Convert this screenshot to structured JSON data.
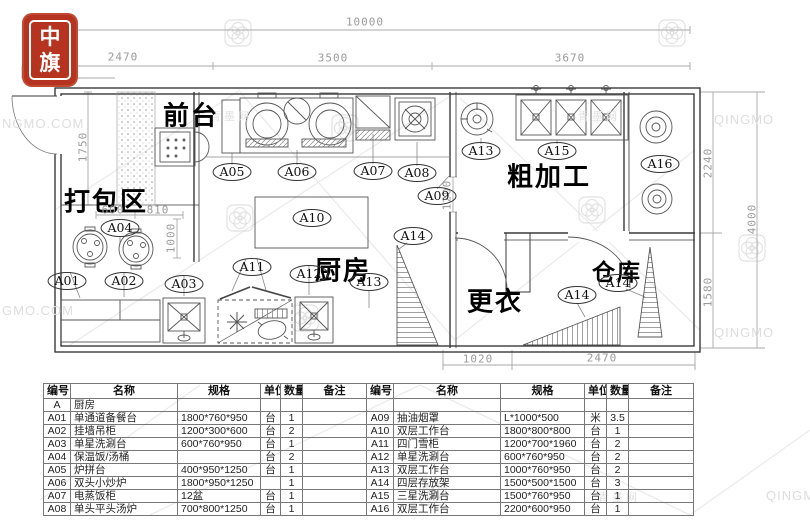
{
  "logo": {
    "char1": "中",
    "char2": "旗",
    "color": "#b5331f"
  },
  "watermarks": {
    "site_partial_left1": "NGMO.COM",
    "site_partial_left2": "GMO.COM",
    "site_short": "QINGMO",
    "cjk": "青墨网"
  },
  "plan": {
    "rooms": {
      "front_desk": "前台",
      "packing_area": "打包区",
      "kitchen": "厨房",
      "rough_processing": "粗加工",
      "changing": "更衣",
      "storage": "仓库"
    },
    "dims": {
      "overall_width": "10000",
      "seg_left": "2470",
      "seg_mid": "3500",
      "seg_right": "3670",
      "front_depth": "1750",
      "right_upper": "2240",
      "right_lower": "1580",
      "overall_height": "4000",
      "pack_a": "600",
      "pack_b": "810",
      "pack_c": "1000",
      "hood_gap": "1200",
      "bottom_left": "1020",
      "bottom_right": "2470"
    },
    "tags": [
      "A05",
      "A06",
      "A07",
      "A08",
      "A13",
      "A15",
      "A16",
      "A09",
      "A10",
      "A04",
      "A01",
      "A02",
      "A03",
      "A11",
      "A12",
      "A13",
      "A14",
      "A14",
      "A14"
    ]
  },
  "table": {
    "headers": {
      "id": "编号",
      "name": "名称",
      "spec": "规格",
      "unit": "单位",
      "qty": "数量",
      "note": "备注"
    },
    "category": {
      "id": "A",
      "name": "厨房"
    },
    "left_rows": [
      {
        "id": "A01",
        "name": "单通道备餐台",
        "spec": "1800*760*950",
        "unit": "台",
        "qty": "1",
        "note": ""
      },
      {
        "id": "A02",
        "name": "挂墙吊柜",
        "spec": "1200*300*600",
        "unit": "台",
        "qty": "2",
        "note": ""
      },
      {
        "id": "A03",
        "name": "单星洗涮台",
        "spec": "600*760*950",
        "unit": "台",
        "qty": "1",
        "note": ""
      },
      {
        "id": "A04",
        "name": "保温饭/汤桶",
        "spec": "",
        "unit": "台",
        "qty": "2",
        "note": ""
      },
      {
        "id": "A05",
        "name": "炉拼台",
        "spec": "400*950*1250",
        "unit": "台",
        "qty": "1",
        "note": ""
      },
      {
        "id": "A06",
        "name": "双头小炒炉",
        "spec": "1800*950*1250",
        "unit": "",
        "qty": "1",
        "note": ""
      },
      {
        "id": "A07",
        "name": "电蒸饭柜",
        "spec": "12盆",
        "unit": "台",
        "qty": "1",
        "note": ""
      },
      {
        "id": "A08",
        "name": "单头平头汤炉",
        "spec": "700*800*1250",
        "unit": "台",
        "qty": "1",
        "note": ""
      }
    ],
    "right_rows": [
      {
        "id": "A09",
        "name": "抽油烟罩",
        "spec": "L*1000*500",
        "unit": "米",
        "qty": "3.5",
        "note": ""
      },
      {
        "id": "A10",
        "name": "双层工作台",
        "spec": "1800*800*800",
        "unit": "台",
        "qty": "1",
        "note": ""
      },
      {
        "id": "A11",
        "name": "四门雪柜",
        "spec": "1200*700*1960",
        "unit": "台",
        "qty": "2",
        "note": ""
      },
      {
        "id": "A12",
        "name": "单星洗涮台",
        "spec": "600*760*950",
        "unit": "台",
        "qty": "2",
        "note": ""
      },
      {
        "id": "A13",
        "name": "双层工作台",
        "spec": "1000*760*950",
        "unit": "台",
        "qty": "2",
        "note": ""
      },
      {
        "id": "A14",
        "name": "四层存放架",
        "spec": "1500*500*1500",
        "unit": "台",
        "qty": "3",
        "note": ""
      },
      {
        "id": "A15",
        "name": "三星洗涮台",
        "spec": "1500*760*950",
        "unit": "台",
        "qty": "1",
        "note": ""
      },
      {
        "id": "A16",
        "name": "双层工作台",
        "spec": "2200*600*950",
        "unit": "台",
        "qty": "1",
        "note": ""
      }
    ]
  }
}
